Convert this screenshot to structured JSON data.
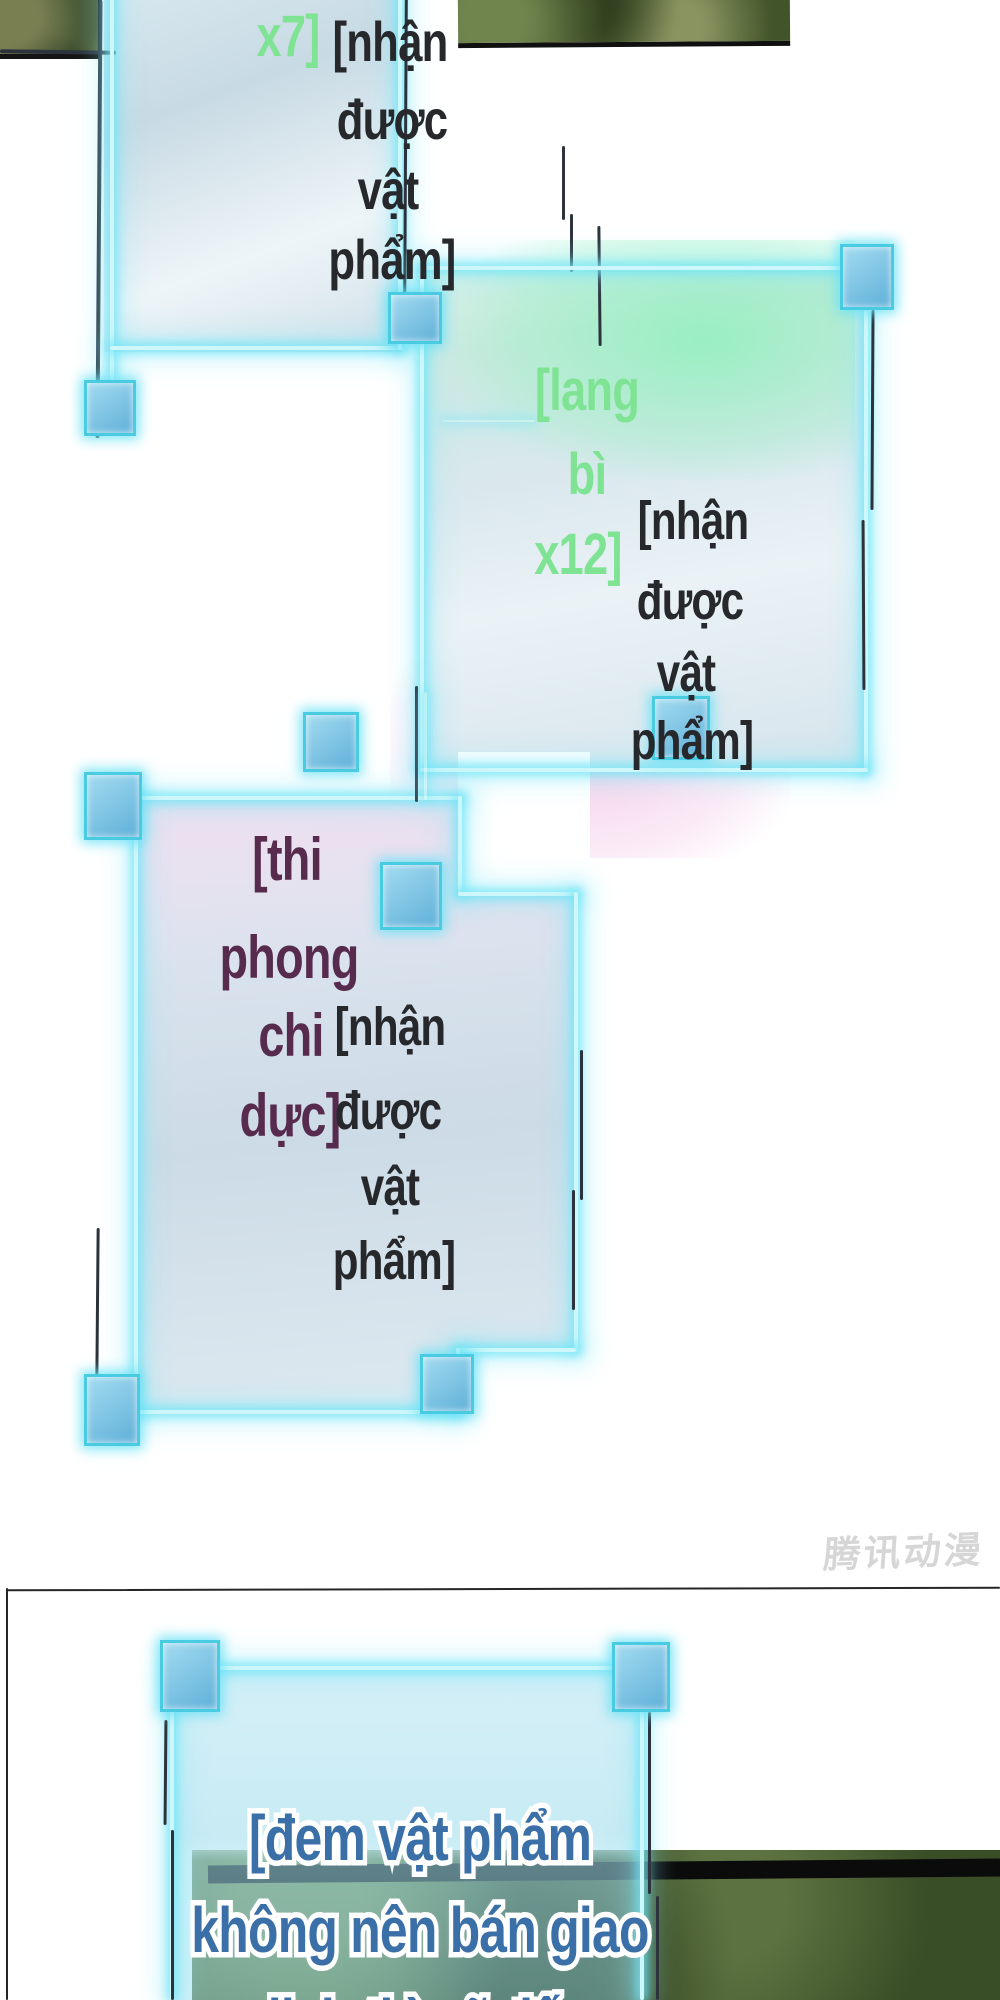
{
  "panels": {
    "p1": {
      "count": "x7]",
      "received": {
        "l1": "[nhận",
        "l2": "được",
        "l3": "vật",
        "l4": "phẩm]"
      }
    },
    "p2": {
      "item": {
        "l1": "[lang",
        "l2": "bì",
        "l3": "x12]"
      },
      "received": {
        "l1": "[nhận",
        "l2": "được",
        "l3": "vật",
        "l4": "phẩm]"
      }
    },
    "p3": {
      "item": {
        "l1": "[thi",
        "l2": "phong",
        "l3": "chi",
        "l4": "dực]"
      },
      "received": {
        "l1": "[nhận",
        "l2": "được",
        "l3": "vật",
        "l4": "phẩm]"
      }
    },
    "p4": {
      "lines": {
        "l1": "[đem vật phẩm",
        "l2": "không nên bán giao",
        "l3": "dịch thì sẽ đến"
      }
    }
  },
  "watermark": "腾讯动漫",
  "colors": {
    "item_green": "#7fe394",
    "item_purple": "#572b4e",
    "body_ink": "#26282b",
    "notice_blue": "#3a6fa8",
    "glow_cyan": "#49cbe2"
  }
}
